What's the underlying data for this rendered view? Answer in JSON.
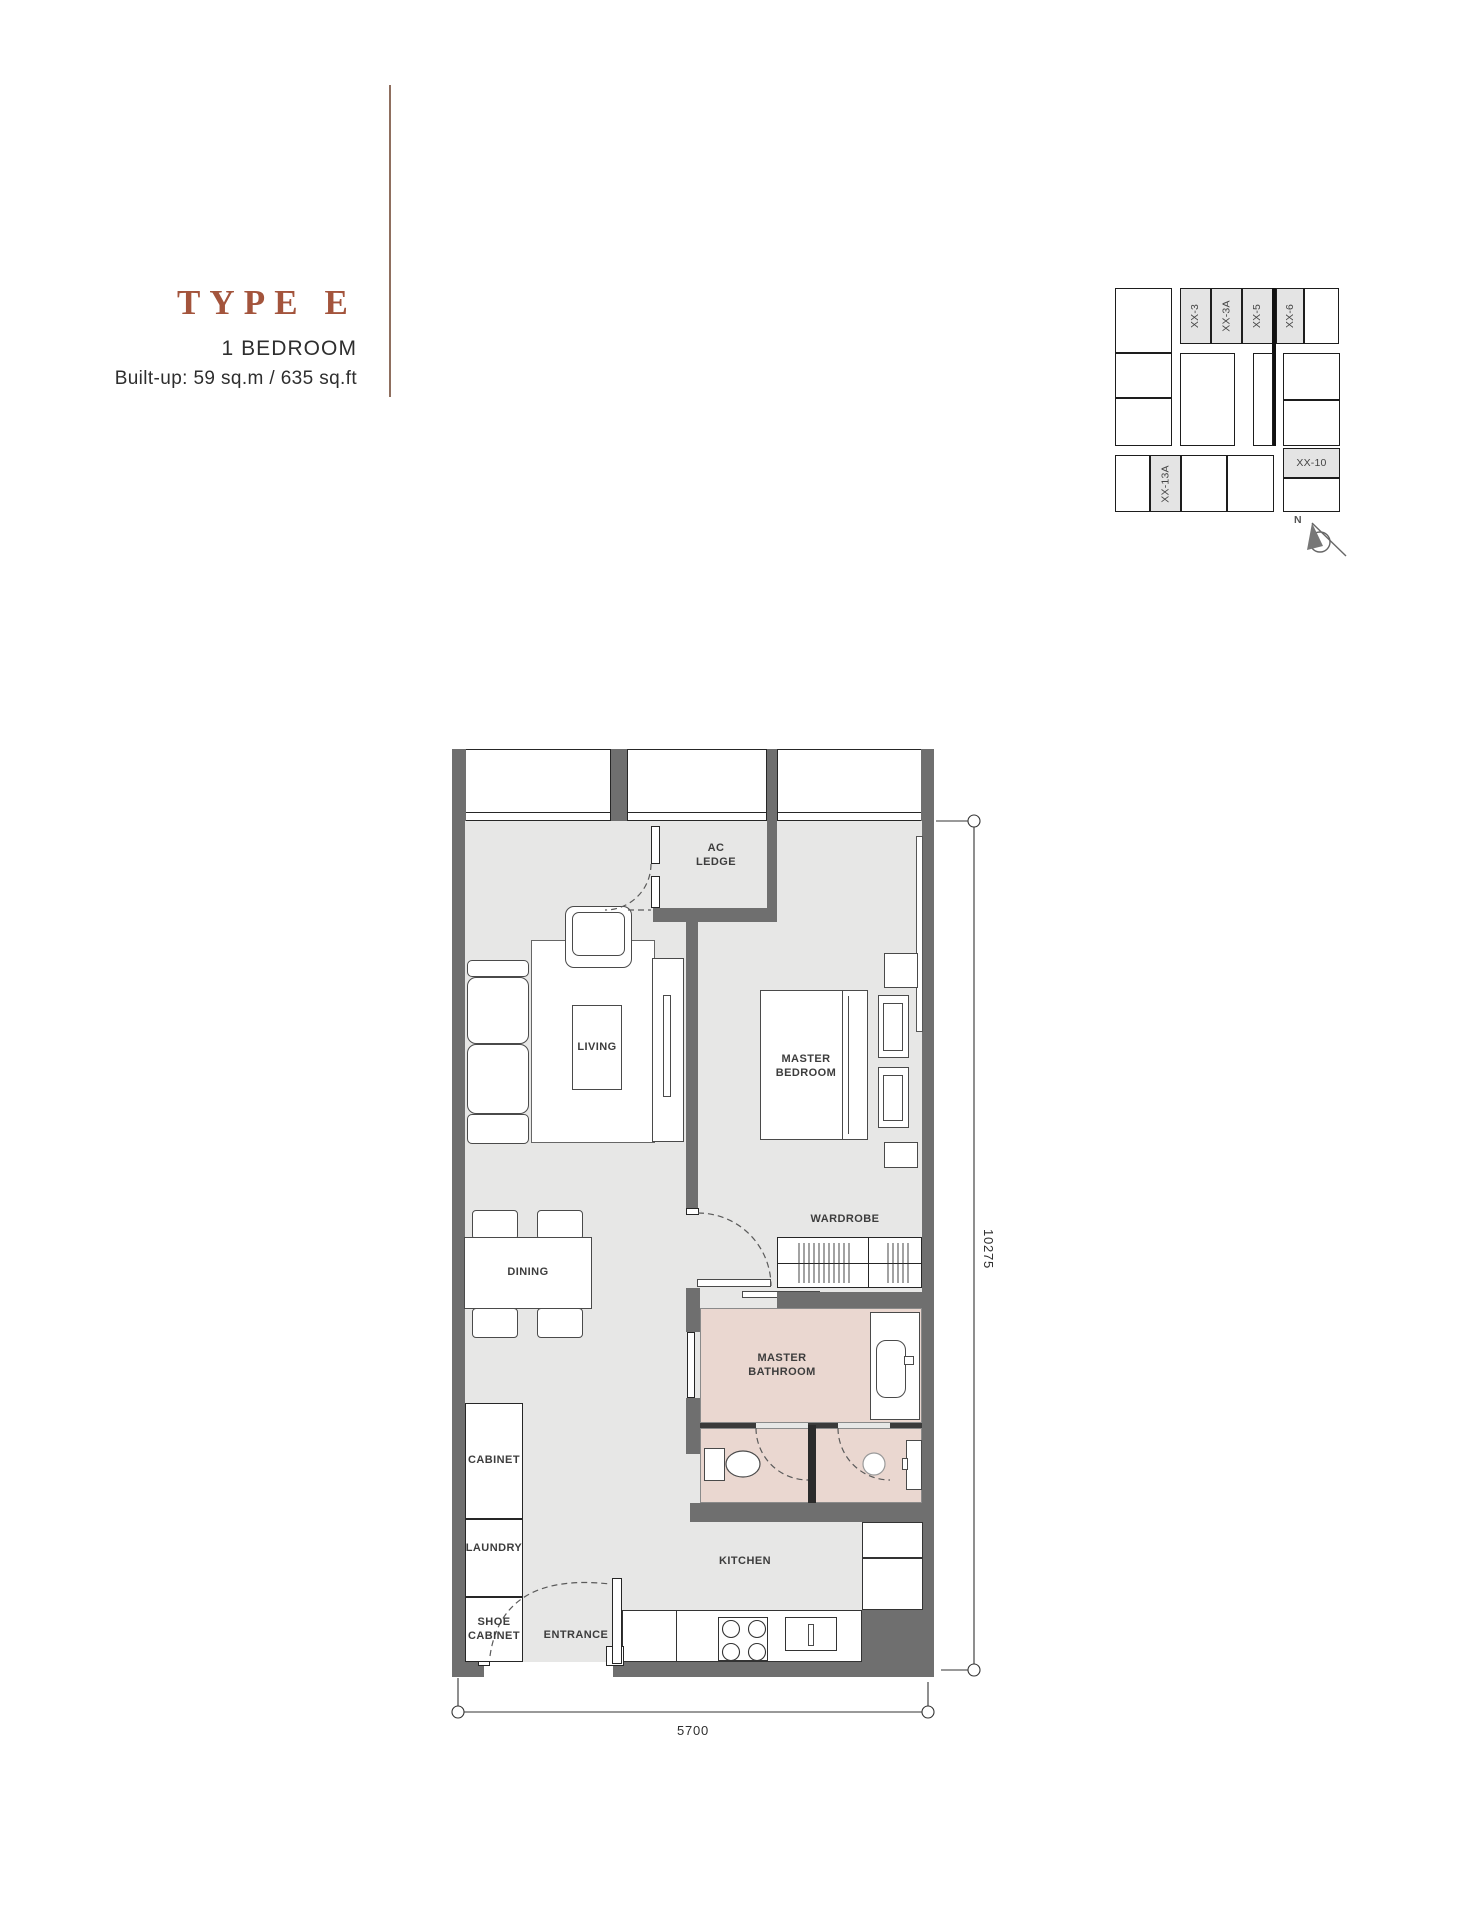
{
  "header": {
    "title": "TYPE E",
    "subtitle": "1 BEDROOM",
    "builtup": "Built-up: 59 sq.m / 635 sq.ft"
  },
  "key_plan": {
    "units": [
      "XX-3",
      "XX-3A",
      "XX-5",
      "XX-6"
    ],
    "unit_right": "XX-10",
    "unit_bottom": "XX-13A",
    "north_label": "N"
  },
  "rooms": {
    "ac_ledge": "AC\nLEDGE",
    "living": "LIVING",
    "master_bedroom": "MASTER\nBEDROOM",
    "wardrobe": "WARDROBE",
    "dining": "DINING",
    "master_bathroom": "MASTER\nBATHROOM",
    "cabinet": "CABINET",
    "laundry": "LAUNDRY",
    "shoe_cabinet": "SHOE\nCABINET",
    "entrance": "ENTRANCE",
    "kitchen": "KITCHEN"
  },
  "dimensions": {
    "width": "5700",
    "height": "10275"
  },
  "colors": {
    "accent": "#A3543C",
    "wall": "#6F6F6F",
    "floor": "#E7E7E6",
    "bathroom_floor": "#EAD7D0",
    "keyplan_shade": "#E4E4E4"
  }
}
